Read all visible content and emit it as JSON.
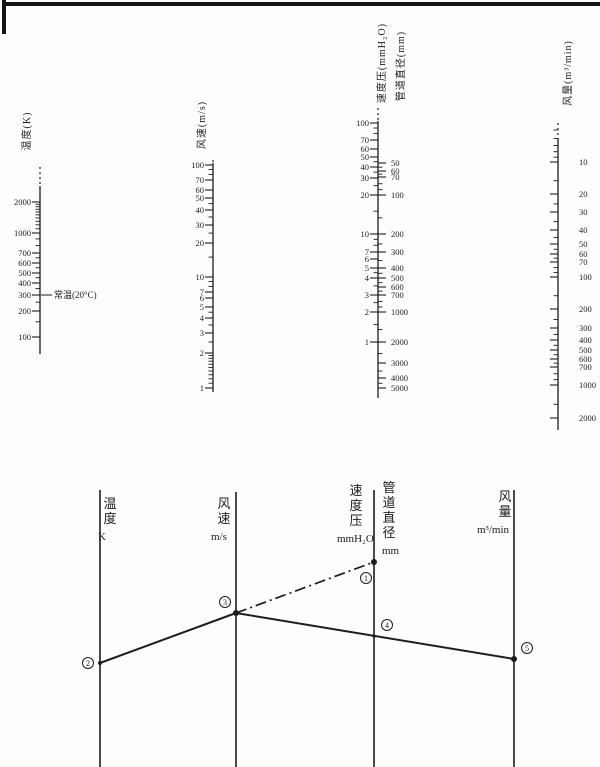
{
  "page": {
    "ink": "#1d1d1b",
    "background": "#fdfdfb"
  },
  "chart_data": {
    "type": "nomogram",
    "description_visible_text_only": true,
    "scales": [
      {
        "id": "temperature",
        "title": "温度(K)",
        "title_x": 30,
        "title_y": 131,
        "x": 40,
        "dash_top": 167,
        "solid_top": 186,
        "bottom": 354,
        "groups": [
          {
            "side": -1,
            "label_side": -1,
            "label_x": 31,
            "majors": [
              [
                2000,
                202
              ],
              [
                1000,
                233
              ],
              [
                700,
                253
              ],
              [
                600,
                263
              ],
              [
                500,
                273
              ],
              [
                400,
                283
              ],
              [
                300,
                295
              ],
              [
                200,
                311
              ],
              [
                100,
                337
              ]
            ],
            "minors": [
              1900,
              1800,
              1700,
              1600,
              1500,
              1400,
              1300,
              1200,
              1100,
              900,
              800,
              650,
              550,
              450,
              350,
              250,
              150
            ]
          }
        ],
        "annotation": {
          "text": "常温(20°C)",
          "y": 295,
          "line_x1": 41,
          "line_x2": 52,
          "text_x": 54
        }
      },
      {
        "id": "air-velocity",
        "title": "风速(m/s)",
        "title_x": 205,
        "title_y": 125,
        "x": 213,
        "dash_top": 160,
        "solid_top": 163,
        "bottom": 392,
        "groups": [
          {
            "side": -1,
            "label_side": -1,
            "label_x": 204,
            "majors": [
              [
                100,
                165
              ],
              [
                70,
                180
              ],
              [
                60,
                190
              ],
              [
                50,
                198
              ],
              [
                40,
                210
              ],
              [
                30,
                225
              ],
              [
                20,
                243
              ],
              [
                10,
                277
              ],
              [
                7,
                292
              ],
              [
                6,
                298
              ],
              [
                5,
                307
              ],
              [
                4,
                318
              ],
              [
                3,
                333
              ],
              [
                2,
                353
              ],
              [
                1,
                388
              ]
            ],
            "minors": [
              90,
              80,
              45,
              35,
              25,
              15,
              9,
              8,
              4.5,
              3.5,
              2.5,
              1.9,
              1.8,
              1.7,
              1.6,
              1.5,
              1.4,
              1.3,
              1.2,
              1.1
            ]
          }
        ]
      },
      {
        "id": "velocity-pressure-and-duct-diameter",
        "title": "速度压(mmH₂O)",
        "title_x": 385,
        "title_y": 63,
        "title2": "管道直径(mm)",
        "title2_x": 404,
        "title2_y": 66,
        "x": 378,
        "dash_top": 108,
        "solid_top": 121,
        "bottom": 398,
        "groups": [
          {
            "side": -1,
            "label_side": -1,
            "label_x": 369,
            "majors": [
              [
                100,
                123
              ],
              [
                70,
                140
              ],
              [
                60,
                149
              ],
              [
                50,
                157
              ],
              [
                40,
                167
              ],
              [
                30,
                178
              ],
              [
                20,
                195
              ],
              [
                10,
                234
              ],
              [
                7,
                252
              ],
              [
                6,
                259
              ],
              [
                5,
                268
              ],
              [
                4,
                278
              ],
              [
                3,
                295
              ],
              [
                2,
                312
              ],
              [
                1,
                342
              ]
            ],
            "minors": [
              90,
              80,
              45,
              35,
              25,
              15,
              9,
              8,
              4.5,
              3.5,
              2.5,
              1.5
            ]
          },
          {
            "side": 1,
            "label_side": 1,
            "label_x": 391,
            "majors": [
              [
                50,
                163
              ],
              [
                60,
                171
              ],
              [
                70,
                177
              ],
              [
                100,
                195
              ],
              [
                200,
                234
              ],
              [
                300,
                252
              ],
              [
                400,
                268
              ],
              [
                500,
                278
              ],
              [
                600,
                287
              ],
              [
                700,
                295
              ],
              [
                1000,
                312
              ],
              [
                2000,
                342
              ],
              [
                3000,
                363
              ],
              [
                4000,
                378
              ],
              [
                5000,
                388
              ]
            ],
            "minors": [
              55,
              65,
              80,
              90,
              150,
              250,
              350,
              450,
              550,
              650,
              800,
              900,
              1500,
              2500,
              3500,
              4500
            ]
          }
        ]
      },
      {
        "id": "air-volume",
        "title": "风量(m³/min)",
        "title_x": 571,
        "title_y": 73,
        "x": 558,
        "dash_top": 123,
        "solid_top": 138,
        "bottom": 430,
        "groups": [
          {
            "side": -1,
            "label_side": 1,
            "label_x": 579,
            "majors": [
              [
                10,
                162
              ],
              [
                20,
                194
              ],
              [
                30,
                212
              ],
              [
                40,
                230
              ],
              [
                50,
                244
              ],
              [
                60,
                254
              ],
              [
                70,
                262
              ],
              [
                100,
                277
              ],
              [
                200,
                309
              ],
              [
                300,
                328
              ],
              [
                400,
                340
              ],
              [
                500,
                350
              ],
              [
                600,
                359
              ],
              [
                700,
                367
              ],
              [
                1000,
                385
              ],
              [
                2000,
                418
              ]
            ],
            "minors": [
              5,
              6,
              7,
              8,
              9,
              15,
              25,
              35,
              45,
              55,
              65,
              80,
              90,
              150,
              250,
              350,
              450,
              550,
              650,
              800,
              900,
              1500
            ]
          }
        ]
      }
    ],
    "schematic": {
      "bottom": 767,
      "axes": [
        {
          "x": 100,
          "top": 490,
          "chars": [
            "温",
            "度"
          ],
          "unit": "K",
          "char_x": 110,
          "unit_x": 98,
          "label_top": 496
        },
        {
          "x": 236,
          "top": 492,
          "chars": [
            "风",
            "速"
          ],
          "unit": "m/s",
          "char_x": 224,
          "unit_x": 211,
          "label_top": 496
        },
        {
          "x": 374,
          "top": 490,
          "chars": [
            "速",
            "度",
            "压"
          ],
          "unit": "mmH₂O",
          "char_x": 356,
          "unit_x": 337,
          "label_top": 483
        },
        {
          "x": 374,
          "skip_line": true,
          "chars": [
            "管",
            "道",
            "直",
            "径"
          ],
          "unit": "mm",
          "char_x": 389,
          "unit_x": 382,
          "label_top": 480
        },
        {
          "x": 514,
          "top": 490,
          "chars": [
            "风",
            "量"
          ],
          "unit": "m³/min",
          "char_x": 505,
          "unit_x": 477,
          "label_top": 489
        }
      ],
      "lines": [
        {
          "x1": 100,
          "y1": 663,
          "x2": 236,
          "y2": 613,
          "style": "solid"
        },
        {
          "x1": 236,
          "y1": 613,
          "x2": 374,
          "y2": 562,
          "style": "dashdot"
        },
        {
          "x1": 236,
          "y1": 613,
          "x2": 514,
          "y2": 659,
          "style": "solid"
        }
      ],
      "points": [
        {
          "glyph": "①",
          "digit": "1",
          "dot_x": 374,
          "dot_y": 562,
          "dot_r": 3,
          "label_x": 366,
          "label_y": 578
        },
        {
          "glyph": "②",
          "digit": "2",
          "dot_x": 100,
          "dot_y": 663,
          "dot_r": 2,
          "label_x": 88,
          "label_y": 663
        },
        {
          "glyph": "③",
          "digit": "3",
          "dot_x": 236,
          "dot_y": 613,
          "dot_r": 3,
          "label_x": 225,
          "label_y": 602
        },
        {
          "glyph": "④",
          "digit": "4",
          "dot_x": 374,
          "dot_y": 636,
          "dot_r": 1.8,
          "label_x": 387,
          "label_y": 625
        },
        {
          "glyph": "⑤",
          "digit": "5",
          "dot_x": 514,
          "dot_y": 659,
          "dot_r": 3,
          "label_x": 527,
          "label_y": 648
        }
      ]
    }
  }
}
